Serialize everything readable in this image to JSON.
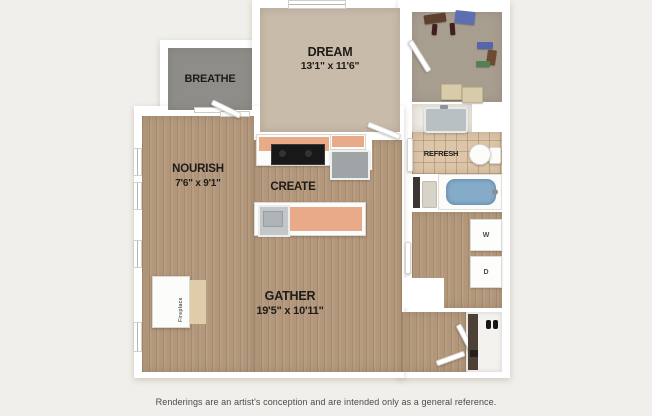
{
  "plan": {
    "rooms": {
      "breathe": {
        "label": "BREATHE"
      },
      "dream": {
        "label": "DREAM",
        "dims": "13'1\" x 11'6\""
      },
      "nourish": {
        "label": "NOURISH",
        "dims": "7'6\" x 9'1\""
      },
      "create": {
        "label": "CREATE"
      },
      "refresh": {
        "label": "REFRESH"
      },
      "gather": {
        "label": "GATHER",
        "dims": "19'5\" x 10'11\""
      }
    },
    "fixtures": {
      "washer_label": "W",
      "dryer_label": "D",
      "fireplace_label": "Fireplace"
    },
    "colors": {
      "background": "#f1efeb",
      "wall": "#ffffff",
      "wood_floor": "#b2977b",
      "bedroom_carpet": "#c8bbaa",
      "closet_carpet": "#a89e90",
      "balcony_concrete": "#8e8d89",
      "bathroom_tile": "#dcc5a9",
      "vanity_floor": "#eeebe5",
      "tub_water": "#84abc7",
      "counter_top": "#e9aa8a",
      "label_text": "#1e1c19"
    }
  },
  "footer": {
    "disclaimer": "Renderings are an artist's conception and are intended only as a general reference."
  }
}
